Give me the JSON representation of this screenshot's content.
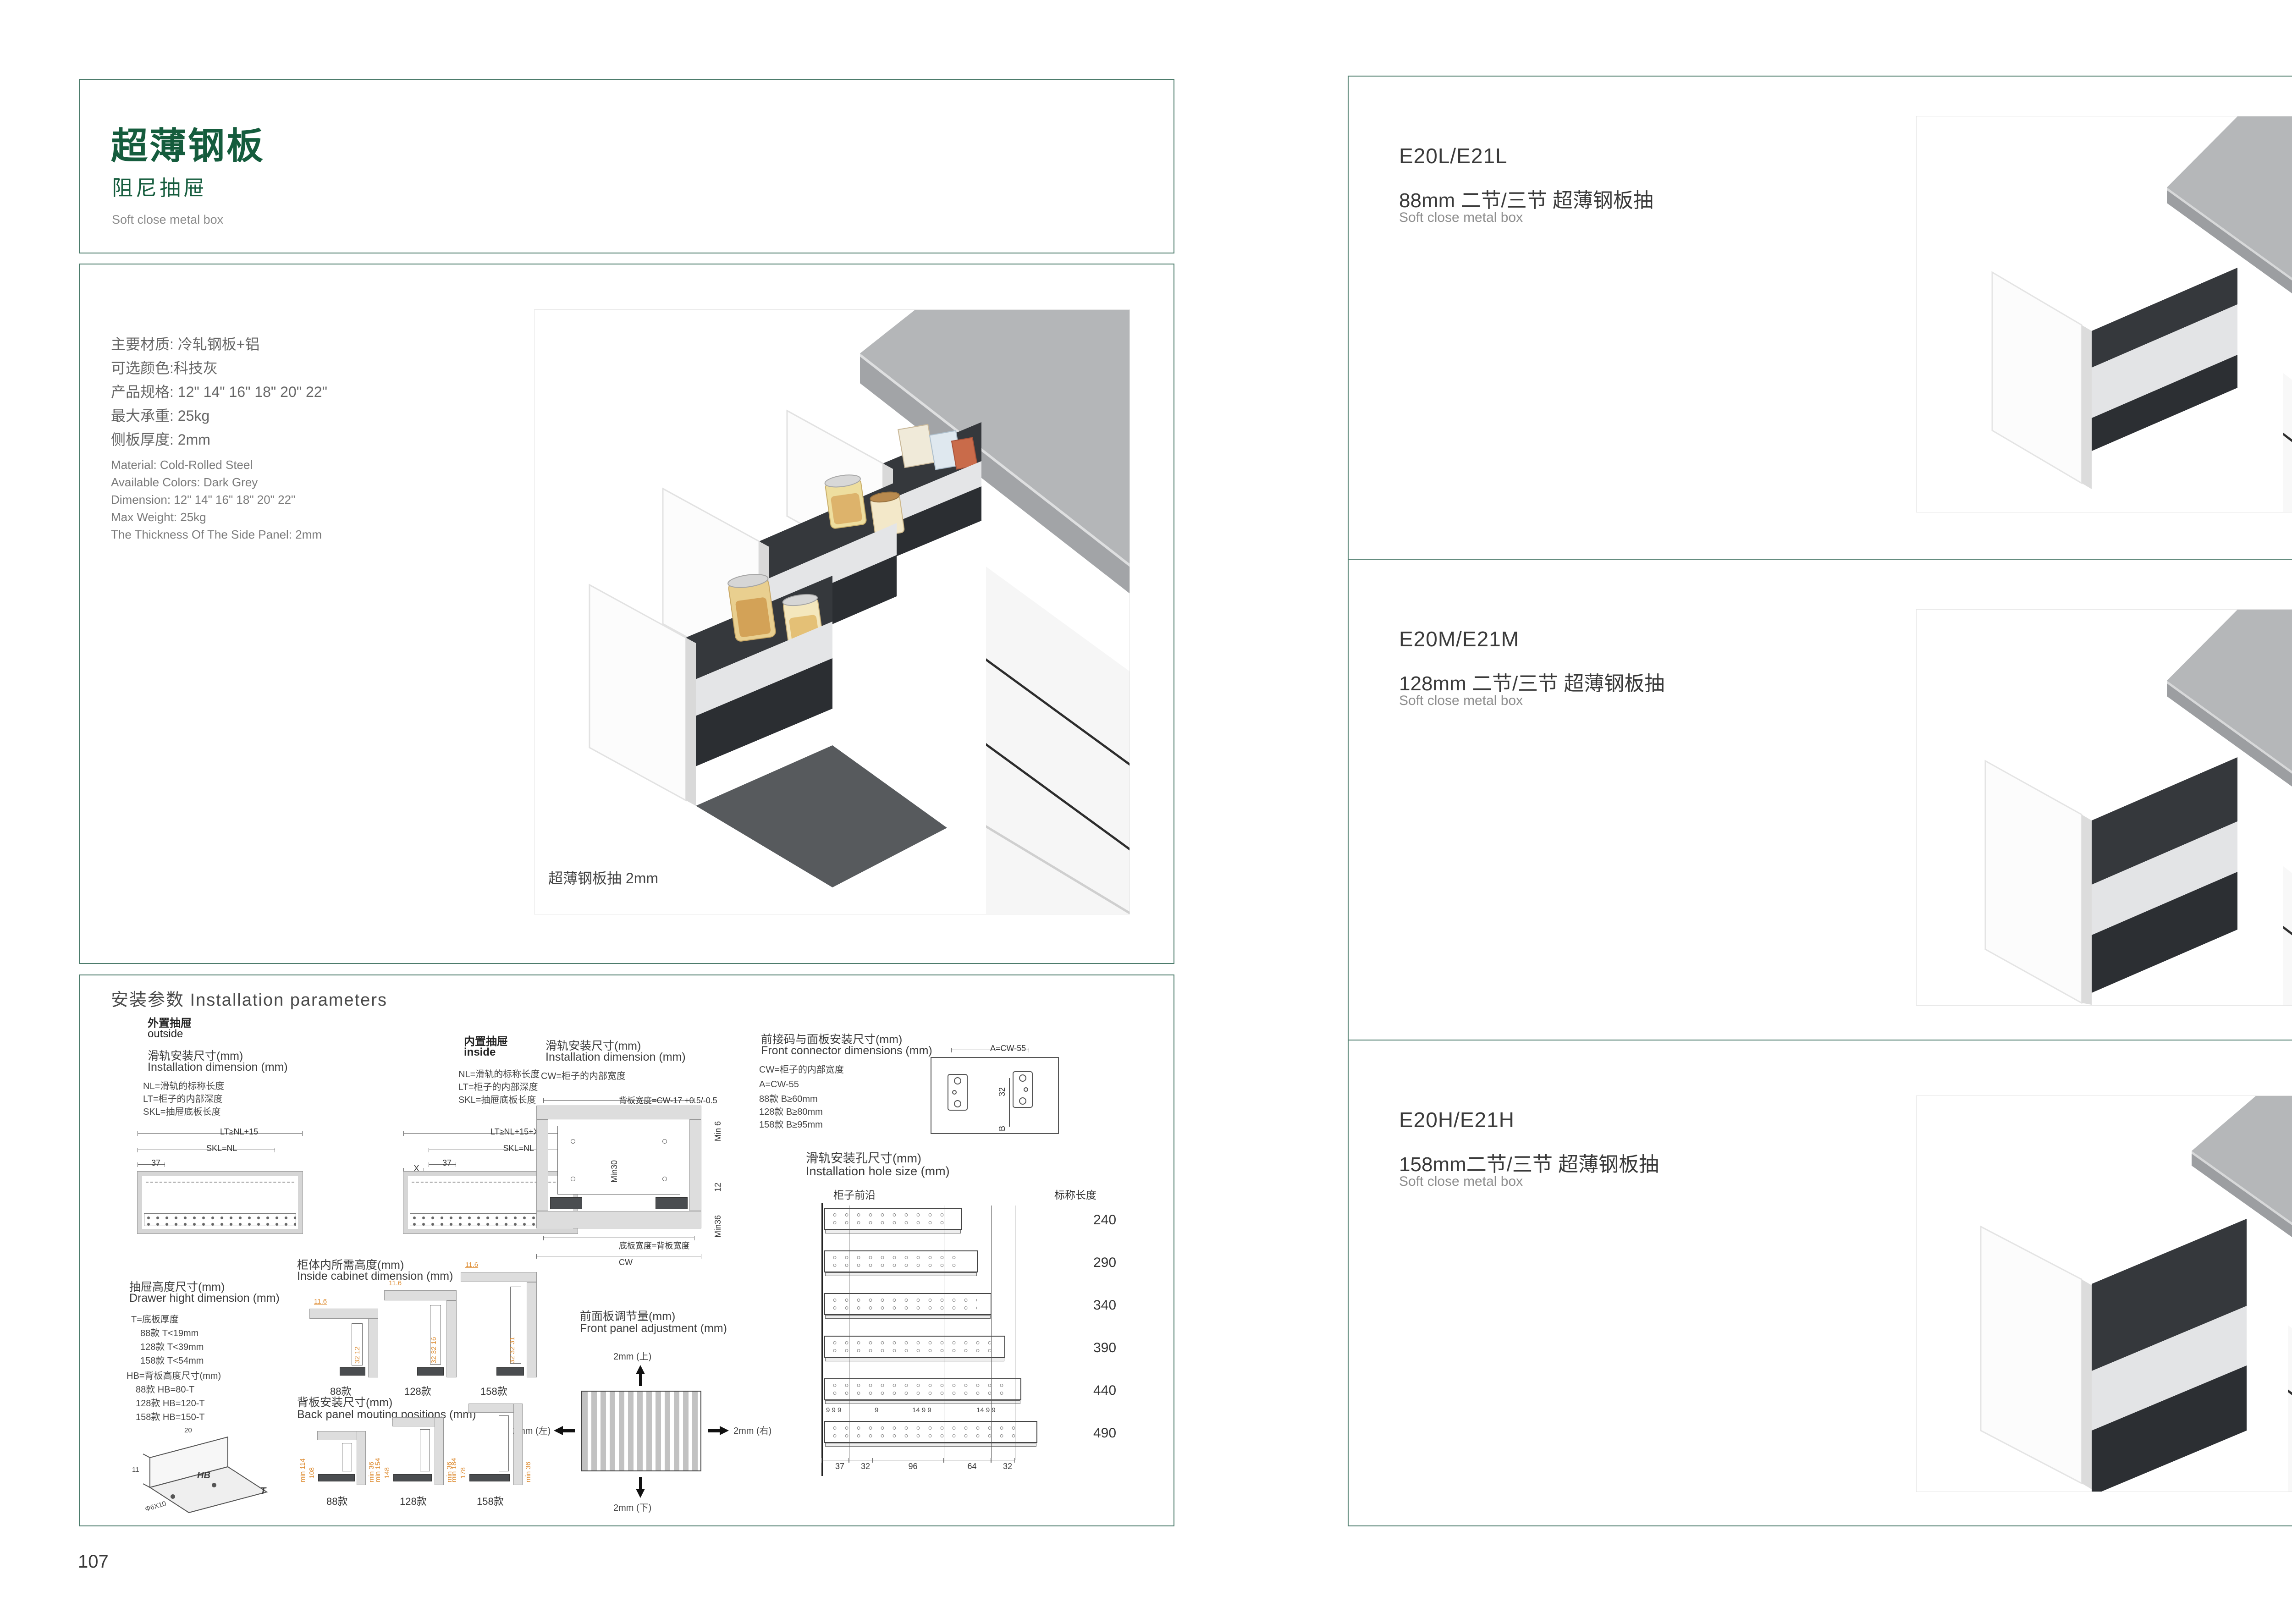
{
  "page_left": {
    "page_number": "107",
    "header": {
      "title": "超薄钢板",
      "subtitle": "阻尼抽屉",
      "subtitle_en": "Soft close metal box"
    },
    "specs_cn": [
      "主要材质: 冷轧钢板+铝",
      "可选颜色:科技灰",
      "产品规格: 12\" 14\" 16\" 18\" 20\" 22\"",
      "最大承重: 25kg",
      "侧板厚度: 2mm"
    ],
    "specs_en": [
      "Material: Cold-Rolled Steel",
      "Available Colors: Dark Grey",
      "Dimension: 12\" 14\" 16\" 18\" 20\" 22\"",
      "Max Weight: 25kg",
      "The Thickness Of The Side Panel: 2mm"
    ],
    "photo_caption": "超薄钢板抽 2mm",
    "install": {
      "section_title": "安装参数 Installation parameters",
      "outside": {
        "tag_cn": "外置抽屉",
        "tag_en": "outside",
        "title_cn": "滑轨安装尺寸(mm)",
        "title_en": "Installation dimension (mm)",
        "legend": [
          "NL=滑轨的标称长度",
          "LT=柜子的内部深度",
          "SKL=抽屉底板长度"
        ],
        "dim_top": "LT≥NL+15",
        "dim_mid": "SKL=NL",
        "dim_small": "37"
      },
      "inside": {
        "tag_cn": "内置抽屉",
        "tag_en": "inside",
        "legend": [
          "NL=滑轨的标称长度",
          "LT=柜子的内部深度",
          "SKL=抽屉底板长度"
        ],
        "dim_top": "LT≥NL+15+X",
        "dim_mid": "SKL=NL",
        "dim_small": "37",
        "dim_x": "X"
      },
      "rail_width": {
        "title_cn": "滑轨安装尺寸(mm)",
        "title_en": "Installation dimension (mm)",
        "legend": "CW=柜子的内部宽度",
        "dim_top": "背板宽度=CW-17 +0.5/-0.5",
        "dim_min6": "Min 6",
        "dim_min30": "Min30",
        "dim_12": "12",
        "dim_min36": "Min36",
        "dim_bottom": "底板宽度=背板宽度",
        "dim_cw": "CW"
      },
      "front_connector": {
        "title_cn": "前接码与面板安装尺寸(mm)",
        "title_en": "Front connector  dimensions (mm)",
        "legend": [
          "CW=柜子的内部宽度",
          "A=CW-55",
          "88款   B≥60mm",
          "128款 B≥80mm",
          "158款 B≥95mm"
        ],
        "dim_a": "A=CW-55",
        "dim_32": "32",
        "dim_b": "B"
      },
      "drawer_height": {
        "title_cn": "抽屉高度尺寸(mm)",
        "title_en": "Drawer hight dimension (mm)",
        "legend_t": [
          "T=底板厚度",
          "88款   T<19mm",
          "128款 T<39mm",
          "158款 T<54mm"
        ],
        "legend_hb": [
          "HB=背板高度尺寸(mm)",
          "88款   HB=80-T",
          "128款 HB=120-T",
          "158款 HB=150-T"
        ],
        "iso": {
          "d20": "20",
          "d11": "11",
          "screw": "Φ6X10",
          "hb": "HB",
          "t": "T"
        }
      },
      "inside_cabinet": {
        "title_cn": "柜体内所需高度(mm)",
        "title_en": "Inside cabinet dimension (mm)",
        "variants": [
          {
            "name": "88款",
            "top": "11.6",
            "side": "32 12"
          },
          {
            "name": "128款",
            "top": "11.6",
            "side": "32 32 16"
          },
          {
            "name": "158款",
            "top": "11.6",
            "side": "32 32 31"
          }
        ]
      },
      "front_adjust": {
        "title_cn": "前面板调节量(mm)",
        "title_en": "Front panel adjustment (mm)",
        "up": "2mm (上)",
        "down": "2mm (下)",
        "left": "2mm (左)",
        "right": "2mm (右)"
      },
      "back_panel": {
        "title_cn": "背板安装尺寸(mm)",
        "title_en": "Back panel mouting positions (mm)",
        "variants": [
          {
            "name": "88款",
            "outer": "min 114",
            "inner": "108",
            "bottom": "min 36"
          },
          {
            "name": "128款",
            "outer": "min 154",
            "inner": "148",
            "bottom": "min 36"
          },
          {
            "name": "158款",
            "outer": "min 184",
            "inner": "178",
            "bottom": "min 36"
          }
        ]
      },
      "hole_size": {
        "title_cn": "滑轨安装孔尺寸(mm)",
        "title_en": "Installation hole size (mm)",
        "front_edge": "柜子前沿",
        "length_header": "标称长度",
        "lengths": [
          "240",
          "290",
          "340",
          "390",
          "440",
          "490"
        ],
        "pitch_dims": [
          "37",
          "32",
          "96",
          "64",
          "32"
        ],
        "micro_dims": [
          "9 9 9",
          "9",
          "14 9 9",
          "14 9 9"
        ]
      }
    }
  },
  "page_right": {
    "page_number": "108",
    "sections": [
      {
        "code": "E20L/E21L",
        "name_cn": "88mm 二节/三节 超薄钢板抽",
        "name_en": "Soft close metal box"
      },
      {
        "code": "E20M/E21M",
        "name_cn": "128mm 二节/三节 超薄钢板抽",
        "name_en": "Soft close metal box"
      },
      {
        "code": "E20H/E21H",
        "name_cn": "158mm二节/三节 超薄钢板抽",
        "name_en": "Soft close metal box"
      }
    ]
  }
}
